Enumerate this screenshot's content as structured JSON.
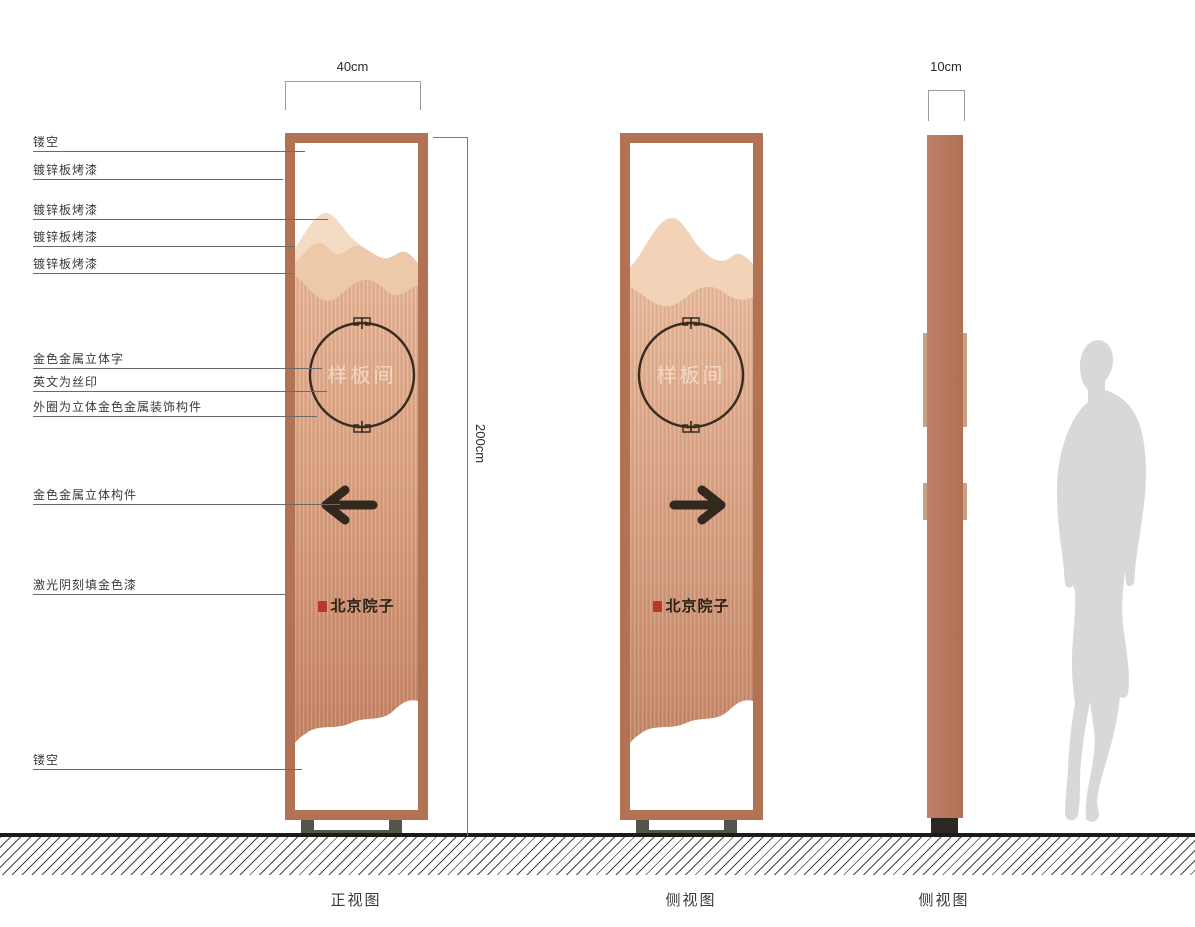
{
  "callouts": [
    {
      "label": "镂空"
    },
    {
      "label": "镀锌板烤漆"
    },
    {
      "label": "镀锌板烤漆"
    },
    {
      "label": "镀锌板烤漆"
    },
    {
      "label": "镀锌板烤漆"
    },
    {
      "label": "金色金属立体字"
    },
    {
      "label": "英文为丝印"
    },
    {
      "label": "外圈为立体金色金属装饰构件"
    },
    {
      "label": "金色金属立体构件"
    },
    {
      "label": "激光阴刻填金色漆"
    },
    {
      "label": "镂空"
    }
  ],
  "dimensions": {
    "front_width": "40cm",
    "height": "200cm",
    "side_thickness": "10cm"
  },
  "views": {
    "front": {
      "caption": "正视图",
      "arrow_direction": "left"
    },
    "side": {
      "caption": "侧视图",
      "arrow_direction": "right"
    },
    "profile": {
      "caption": "侧视图"
    }
  },
  "panel_text": {
    "circle_label": "样板间",
    "brand": "北京院子"
  },
  "icons": {
    "arrow_left": "left direction arrow glyph",
    "arrow_right": "right direction arrow glyph",
    "seal": "red calligraphy seal square",
    "fret_ornament": "greek-key meander on circle ring"
  },
  "colors": {
    "frame": "#b27355",
    "body_top": "#e4b295",
    "body_bottom": "#c08162",
    "mountain_back": "#f4dcc4",
    "mountain_mid": "#ecc9a9",
    "mountain_side_view": "#f2d3b8",
    "ink": "#33281e",
    "seal_red": "#b5382a",
    "base_bracket": "#54554a",
    "profile_base": "#2d2922",
    "ground": "#1d1b18",
    "silhouette": "#d8d8d8"
  }
}
